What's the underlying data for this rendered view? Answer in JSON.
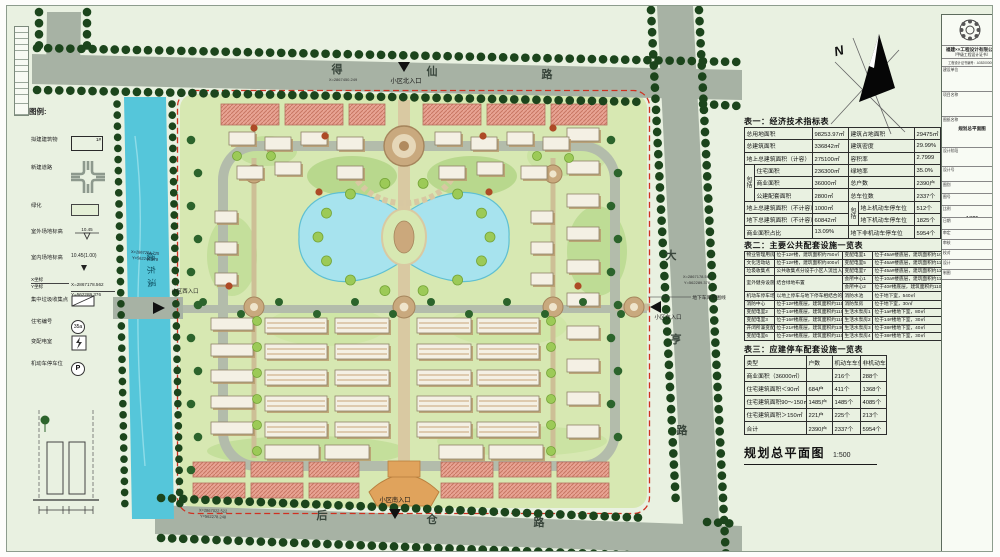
{
  "drawing_title": {
    "text": "规划总平面图",
    "scale": "1:500"
  },
  "compass": {
    "north_label": "N"
  },
  "colors": {
    "accent_red_boundary": "#d03020",
    "river": "#55c6da",
    "lake": "#a7e3ee",
    "road": "#a7b2a4",
    "tree": "#1c451c",
    "commercial": "#e8a494"
  },
  "legend": {
    "title": "图例:",
    "items": [
      {
        "label": "拟建建筑物",
        "type": "building",
        "text": "1#",
        "y": 16
      },
      {
        "label": "新建道路",
        "type": "road",
        "y": 44
      },
      {
        "label": "绿化",
        "type": "green",
        "y": 82
      },
      {
        "label": "室外场地标高",
        "type": "elev-out",
        "text": "10.45",
        "y": 108
      },
      {
        "label": "室内场地标高",
        "type": "elev-in",
        "text": "10.45(1.00)",
        "y": 134
      },
      {
        "label": "X坐标",
        "label2": "Y坐标",
        "type": "coord",
        "text": "X=2867178.562",
        "text2": "Y=562289.376",
        "y": 156
      },
      {
        "label": "集中垃圾收集点",
        "type": "trash",
        "y": 176
      },
      {
        "label": "住宅编号",
        "type": "num",
        "text": "35a",
        "y": 198
      },
      {
        "label": "变配电室",
        "type": "power",
        "y": 218
      },
      {
        "label": "机动车停车位",
        "type": "parking",
        "text": "P",
        "y": 240
      }
    ]
  },
  "plan": {
    "road_names": {
      "north": "得仙路",
      "east": "大亨路",
      "south": "后仓路",
      "river": "缓东溪"
    },
    "labels": [
      {
        "t": "得",
        "x": 330,
        "y": 67,
        "s": 11,
        "b": 1,
        "c": "#39463c"
      },
      {
        "t": "仙",
        "x": 425,
        "y": 69,
        "s": 11,
        "b": 1,
        "c": "#39463c"
      },
      {
        "t": "路",
        "x": 540,
        "y": 72,
        "s": 11,
        "b": 1,
        "c": "#39463c"
      },
      {
        "t": "小区北入口",
        "x": 399,
        "y": 77,
        "s": 6.2,
        "c": "#151515"
      },
      {
        "t": "X=2867450.249",
        "x": 336,
        "y": 75,
        "s": 4,
        "c": "#333"
      },
      {
        "t": "大",
        "x": 664,
        "y": 253,
        "s": 11,
        "b": 1,
        "c": "#39463c"
      },
      {
        "t": "亨",
        "x": 669,
        "y": 337,
        "s": 11,
        "b": 1,
        "c": "#39463c"
      },
      {
        "t": "路",
        "x": 675,
        "y": 428,
        "s": 11,
        "b": 1,
        "c": "#39463c"
      },
      {
        "t": "小区东入口",
        "x": 661,
        "y": 313,
        "s": 5.4,
        "c": "#151515"
      },
      {
        "t": "X=2867178.562",
        "x": 690,
        "y": 272,
        "s": 4,
        "c": "#333"
      },
      {
        "t": "Y=562289.376",
        "x": 690,
        "y": 278,
        "s": 4,
        "c": "#333"
      },
      {
        "t": "地下车库范围线",
        "x": 702,
        "y": 293,
        "s": 4.8,
        "c": "#222"
      },
      {
        "t": "后",
        "x": 315,
        "y": 513,
        "s": 11,
        "b": 1,
        "c": "#39463c"
      },
      {
        "t": "仓",
        "x": 425,
        "y": 517,
        "s": 11,
        "b": 1,
        "c": "#39463c"
      },
      {
        "t": "路",
        "x": 532,
        "y": 520,
        "s": 11,
        "b": 1,
        "c": "#39463c"
      },
      {
        "t": "小区南入口",
        "x": 388,
        "y": 496,
        "s": 6.2,
        "c": "#151515"
      },
      {
        "t": "X=2867022.522",
        "x": 206,
        "y": 506,
        "s": 4,
        "c": "#333",
        "rot": 2
      },
      {
        "t": "Y=562278.248",
        "x": 206,
        "y": 512,
        "s": 4,
        "c": "#333",
        "rot": 2
      },
      {
        "t": "小区西入口",
        "x": 178,
        "y": 287,
        "s": 5.4,
        "c": "#151515"
      },
      {
        "t": "缓东溪",
        "x": 141,
        "y": 266,
        "s": 9,
        "rot": 88,
        "ls": 4,
        "c": "#115567"
      },
      {
        "t": "X=2867204.725",
        "x": 138,
        "y": 248,
        "s": 4,
        "c": "#223",
        "rot": 4
      },
      {
        "t": "Y=562248.978",
        "x": 138,
        "y": 254,
        "s": 4,
        "c": "#223",
        "rot": 4
      },
      {
        "t": "N",
        "x": 833,
        "y": 49,
        "s": 13,
        "b": 1,
        "i": 1,
        "rot": -15,
        "c": "#111"
      }
    ]
  },
  "tables": {
    "t1": {
      "title": "表一：经济技术指标表",
      "widths": [
        10,
        58,
        36,
        10,
        56,
        26
      ],
      "rows": [
        [
          {
            "t": "总用地面积",
            "c": 2
          },
          {
            "t": "98253.97㎡"
          },
          {
            "t": "建筑占地面积",
            "c": 2
          },
          {
            "t": "29475㎡"
          }
        ],
        [
          {
            "t": "总建筑面积",
            "c": 2
          },
          {
            "t": "336842㎡"
          },
          {
            "t": "建筑密度",
            "c": 2
          },
          {
            "t": "29.99%"
          }
        ],
        [
          {
            "t": "地上总建筑面积（计容）",
            "c": 2
          },
          {
            "t": "275100㎡"
          },
          {
            "t": "容积率",
            "c": 2
          },
          {
            "t": "2.7999"
          }
        ],
        [
          {
            "t": "包括",
            "r": 3,
            "g": 1
          },
          {
            "t": "住宅面积"
          },
          {
            "t": "236300㎡"
          },
          {
            "t": "绿地率",
            "c": 2
          },
          {
            "t": "35.0%"
          }
        ],
        [
          {
            "t": "商业面积"
          },
          {
            "t": "36000㎡"
          },
          {
            "t": "总户数",
            "c": 2
          },
          {
            "t": "2390户"
          }
        ],
        [
          {
            "t": "公建配套面积"
          },
          {
            "t": "2800㎡"
          },
          {
            "t": "总车位数",
            "c": 2
          },
          {
            "t": "2337个"
          }
        ],
        [
          {
            "t": "地上总建筑面积（不计容）",
            "c": 2
          },
          {
            "t": "1000㎡"
          },
          {
            "t": "包括",
            "r": 2,
            "g": 1
          },
          {
            "t": "地上机动车停车位"
          },
          {
            "t": "512个"
          }
        ],
        [
          {
            "t": "地下总建筑面积（不计容）",
            "c": 2
          },
          {
            "t": "60842㎡"
          },
          {
            "t": "地下机动车停车位"
          },
          {
            "t": "1825个"
          }
        ],
        [
          {
            "t": "商业面积占比",
            "c": 2
          },
          {
            "t": "13.09%"
          },
          {
            "t": "地下非机动车停车位",
            "c": 2
          },
          {
            "t": "5954个"
          }
        ]
      ]
    },
    "t2": {
      "title": "表二：主要公共配套设施一览表",
      "widths": [
        30,
        68,
        30,
        69
      ],
      "rows": [
        [
          {
            "t": "物业管理用房"
          },
          {
            "t": "位于12#楼，建筑面积约750㎡"
          },
          {
            "t": "变配电室1"
          },
          {
            "t": "位于45a#楼底层，建筑面积约100㎡"
          }
        ],
        [
          {
            "t": "文化活动站"
          },
          {
            "t": "位于12#楼，建筑面积约400㎡"
          },
          {
            "t": "变配电室5"
          },
          {
            "t": "位于46a#楼底层，建筑面积约110㎡"
          }
        ],
        [
          {
            "t": "垃圾收集点"
          },
          {
            "t": "公共收集点分设于小区人流出入口使用方便处（3处）"
          },
          {
            "t": "变配电室7"
          },
          {
            "t": "位于45a#楼底层，建筑面积约110㎡"
          }
        ],
        [
          {
            "t": "室外健身设施（宅前屋后供休闲场地）",
            "r": 2
          },
          {
            "t": "结合绿地布置",
            "r": 2
          },
          {
            "t": "会所中心1"
          },
          {
            "t": "位于10a#楼底层，建筑面积约110㎡"
          }
        ],
        [
          {
            "t": "会所中心2"
          },
          {
            "t": "位于40#楼底层，建筑面积约110㎡"
          }
        ],
        [
          {
            "t": "机动车停车场"
          },
          {
            "t": "以地上停车与地下停车相结合的形式设计"
          },
          {
            "t": "消防水池"
          },
          {
            "t": "位于地下室，540㎡"
          }
        ],
        [
          {
            "t": "消防中心"
          },
          {
            "t": "位于12#楼底层，建筑面积约110㎡"
          },
          {
            "t": "消防泵房"
          },
          {
            "t": "位于地下室，30㎡"
          }
        ],
        [
          {
            "t": "变配电室2"
          },
          {
            "t": "位于14#楼底层，建筑面积约110㎡"
          },
          {
            "t": "生活水泵房1"
          },
          {
            "t": "位于1a#楼地下室，80㎡"
          }
        ],
        [
          {
            "t": "变配电室3"
          },
          {
            "t": "位于16#楼底层，建筑面积约110㎡"
          },
          {
            "t": "生活水泵房2"
          },
          {
            "t": "位于14#楼地下室，30㎡"
          }
        ],
        [
          {
            "t": "开闭所兼变配电室4"
          },
          {
            "t": "位于21#楼底层，建筑面积约130㎡"
          },
          {
            "t": "生活水泵房3"
          },
          {
            "t": "位于38#楼地下室，40㎡"
          }
        ],
        [
          {
            "t": "变配电室6"
          },
          {
            "t": "位于25#楼底层，建筑面积约110㎡"
          },
          {
            "t": "生活水泵房4"
          },
          {
            "t": "位于38#楼地下室，30㎡"
          }
        ]
      ]
    },
    "t3": {
      "title": "表三：应建停车配套设施一览表",
      "widths": [
        62,
        26,
        28,
        26
      ],
      "headers": [
        "类型",
        "户数",
        "机动车车位",
        "非机动车"
      ],
      "rows": [
        [
          "商业面积（36000㎡）",
          "",
          "216个",
          "288个"
        ],
        [
          "住宅建筑面积＜90㎡",
          "684户",
          "411个",
          "1368个"
        ],
        [
          "住宅建筑面积90～150㎡",
          "1485户",
          "1485个",
          "4085个"
        ],
        [
          "住宅建筑面积＞150㎡",
          "221户",
          "225个",
          "213个"
        ],
        [
          "合计",
          "2390户",
          "2337个",
          "5954个"
        ]
      ]
    }
  },
  "titleblock": {
    "company": "福建××工程设计有限公司",
    "company_sub": "（甲级工程设计证书）",
    "company_cert": "工程设计证书编号：A352000000",
    "rows": [
      {
        "label": "建设单位",
        "value": "",
        "h": 24
      },
      {
        "label": "项目名称",
        "value": "",
        "h": 24
      },
      {
        "label": "图纸名称",
        "value": "规划总平面图",
        "h": 30
      },
      {
        "label": "设计阶段",
        "value": "",
        "h": 18
      },
      {
        "label": "设计号",
        "value": "",
        "h": 14
      },
      {
        "label": "图别",
        "value": "",
        "h": 11
      },
      {
        "label": "图号",
        "value": "",
        "h": 11
      },
      {
        "label": "比例",
        "value": "1:500",
        "h": 11
      },
      {
        "label": "日期",
        "value": "",
        "h": 11
      },
      {
        "label": "审定",
        "value": "",
        "h": 9
      },
      {
        "label": "审核",
        "value": "",
        "h": 9
      },
      {
        "label": "校对",
        "value": "",
        "h": 9
      },
      {
        "label": "设计",
        "value": "",
        "h": 9
      },
      {
        "label": "制图",
        "value": "",
        "h": 9
      }
    ]
  }
}
